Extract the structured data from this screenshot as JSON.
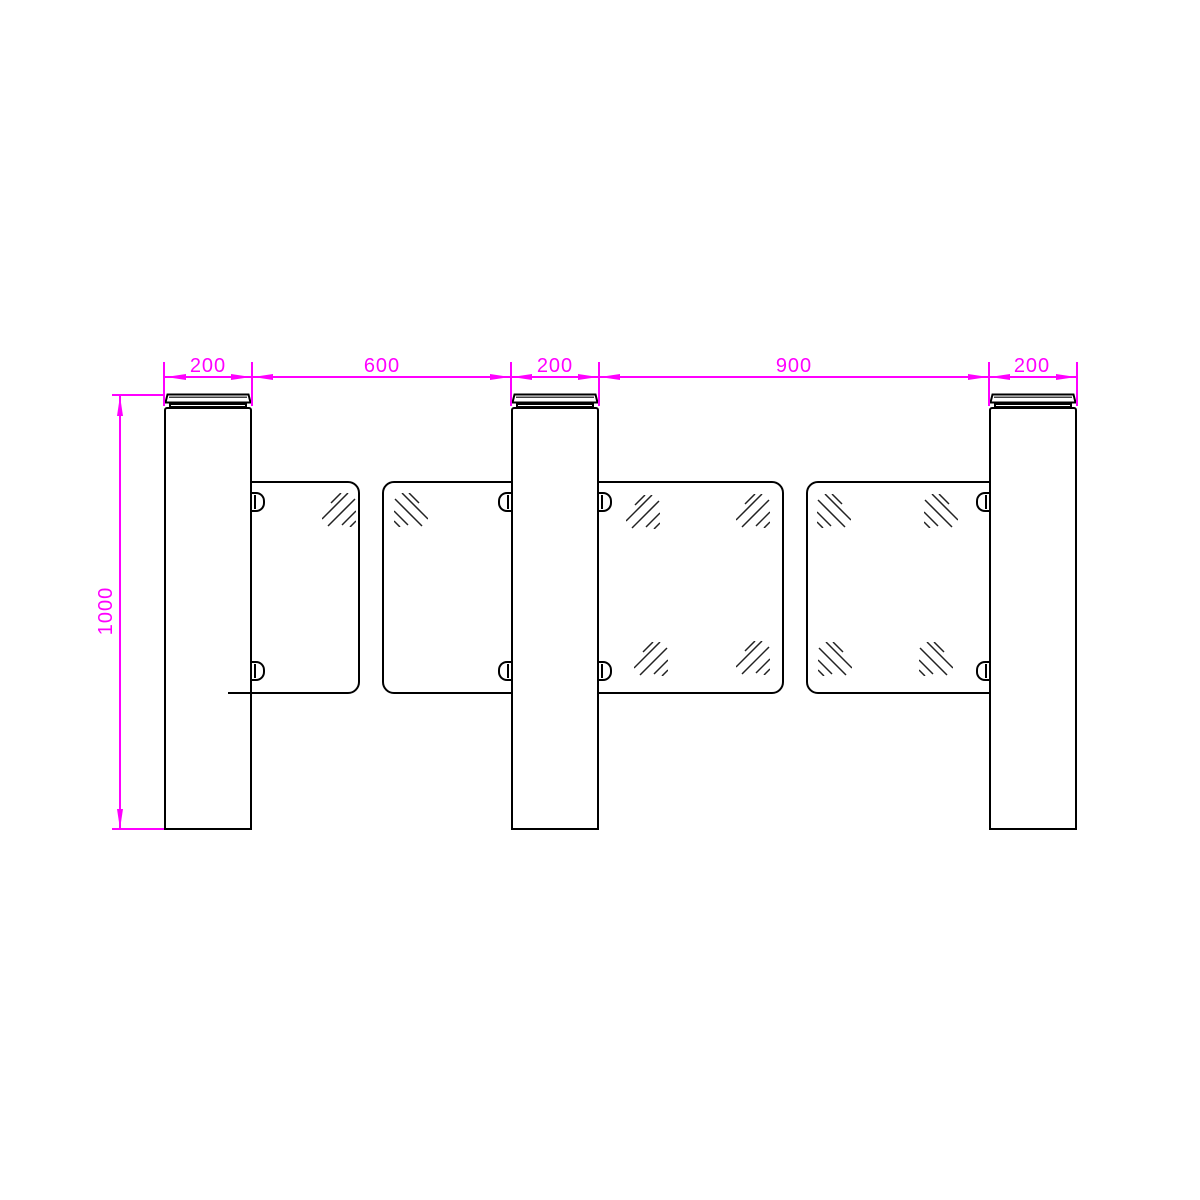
{
  "drawing": {
    "colors": {
      "dimension": "#FF00FF",
      "line": "#000000",
      "background": "#FFFFFF"
    },
    "dimensions": {
      "horizontal": [
        {
          "label": "200"
        },
        {
          "label": "600"
        },
        {
          "label": "200"
        },
        {
          "label": "900"
        },
        {
          "label": "200"
        }
      ],
      "vertical": {
        "label": "1000"
      }
    }
  }
}
